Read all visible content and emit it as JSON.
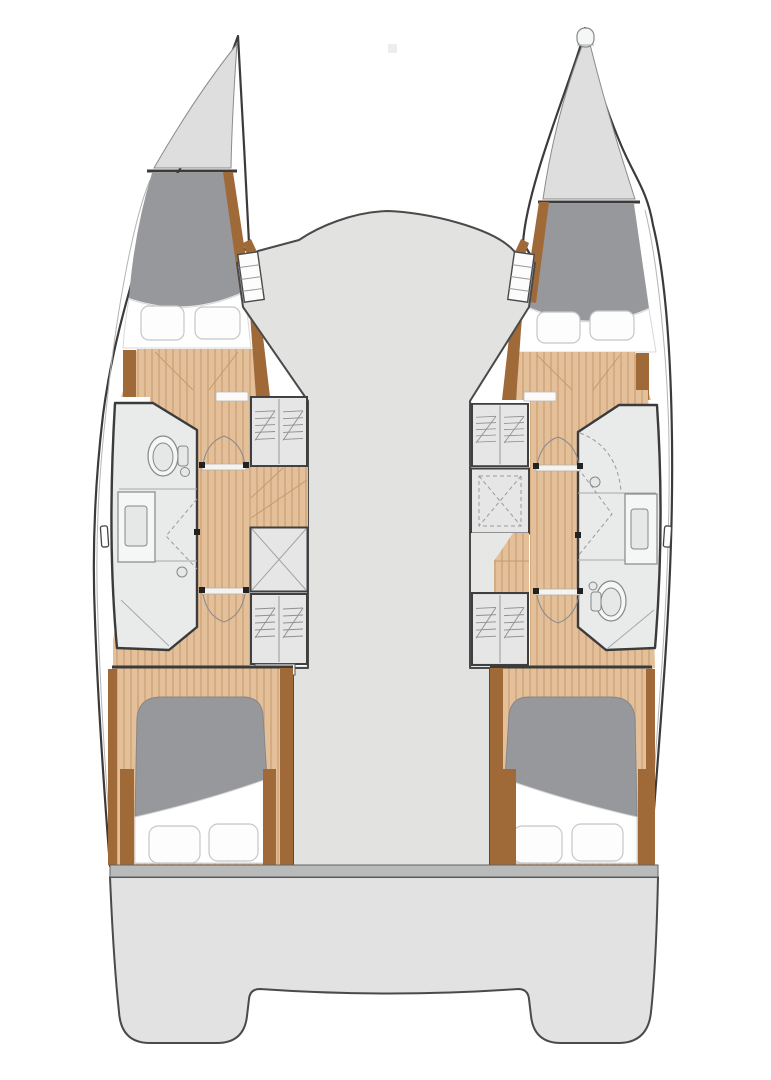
{
  "drawing": {
    "kind": "catamaran-deck-floorplan",
    "view": "top-down",
    "text_labels": [],
    "hulls": [
      {
        "side": "port-left",
        "sections": [
          "bow-locker",
          "forward-berth",
          "companionway-steps",
          "corridor",
          "bathroom",
          "storage-lockers",
          "aft-double-berth"
        ],
        "bathroom_fixtures": [
          "toilet",
          "vanity-sink",
          "shower-drain"
        ],
        "storage_units": [
          "shelved-locker",
          "wood-desk-surface",
          "cross-hatch-locker",
          "shelved-locker"
        ]
      },
      {
        "side": "starboard-right",
        "sections": [
          "bow-locker",
          "forward-berth",
          "companionway-steps",
          "corridor",
          "bathroom",
          "storage-lockers",
          "aft-double-berth"
        ],
        "bathroom_fixtures": [
          "shower-drain",
          "vanity-sink",
          "toilet"
        ],
        "storage_units": [
          "shelved-locker",
          "dashed-cross-locker",
          "wood-seat-surface",
          "shelved-locker"
        ]
      }
    ],
    "center": [
      "foredeck-crossbeam",
      "bridgedeck-saloon-area",
      "stern-platform-with-twin-transoms"
    ]
  },
  "palette": {
    "outline": "#3b3b3c",
    "deck": "#e2e2e1",
    "deckStroke": "#4a4a4b",
    "platform": "#e1e2e1",
    "band": "#b9baba",
    "bow": "#dedede",
    "berth": "#97989b",
    "wood": "#e4c09a",
    "woodStripe": "#d5ab81",
    "woodTrim": "#a06a38",
    "bath": "#e9eaea",
    "fixture": "#85888a",
    "unit": "#e5e6e5",
    "unitStroke": "#3f3f40",
    "background": "#ffffff"
  }
}
